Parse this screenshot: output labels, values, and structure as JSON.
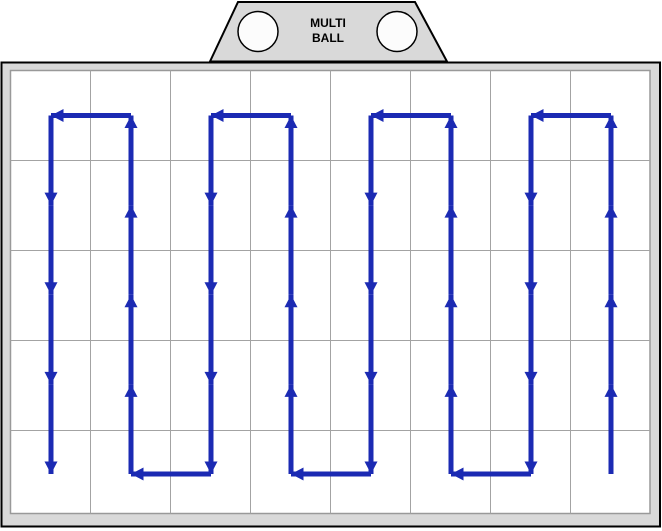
{
  "hopper": {
    "label": {
      "line1": "MULTI",
      "line2": "BALL"
    },
    "shape": {
      "top_y": 2,
      "bottom_y": 61.5,
      "top_x1": 238,
      "top_x2": 415,
      "bottom_x1": 210,
      "bottom_x2": 447
    },
    "circles": [
      {
        "cx": 258,
        "cy": 31.5,
        "r": 20
      },
      {
        "cx": 397,
        "cy": 31.5,
        "r": 20
      }
    ],
    "colors": {
      "fill": "#d9d9d9",
      "stroke": "#000000",
      "circle_fill": "#fcfcfc"
    }
  },
  "field": {
    "outer": {
      "x": 1.5,
      "y": 62.5,
      "width": 658.5,
      "height": 464
    },
    "inner": {
      "x": 10.5,
      "y": 70.5,
      "width": 639.5,
      "height": 443
    },
    "grid": {
      "columns": 8,
      "rows": 5,
      "vertical_lines_x": [
        90.5,
        170.5,
        250.5,
        330.5,
        410.5,
        490.5,
        570.5
      ],
      "horizontal_lines_y": [
        160.5,
        250.5,
        340.5,
        430.5
      ]
    },
    "colors": {
      "band_fill": "#d9d9d9",
      "background": "#ffffff",
      "grid_line": "#a3a3a3",
      "inner_border": "#999999",
      "outer_border": "#000000"
    }
  },
  "route": {
    "type": "serpentine-coverage-path",
    "color": "#1b2ab3",
    "stroke_width": 5,
    "arrowhead": {
      "length": 13,
      "width": 12
    },
    "column_centers_x": [
      51,
      131,
      211,
      291,
      371,
      451,
      531,
      611
    ],
    "top_y": 115.5,
    "bottom_y": 474,
    "arrows_per_vertical": 4,
    "sweep_order": "right_to_left",
    "start": {
      "column_index": 7,
      "at": "bottom",
      "direction": "up"
    },
    "end": {
      "column_index": 0,
      "at": "bottom",
      "direction": "down"
    }
  }
}
